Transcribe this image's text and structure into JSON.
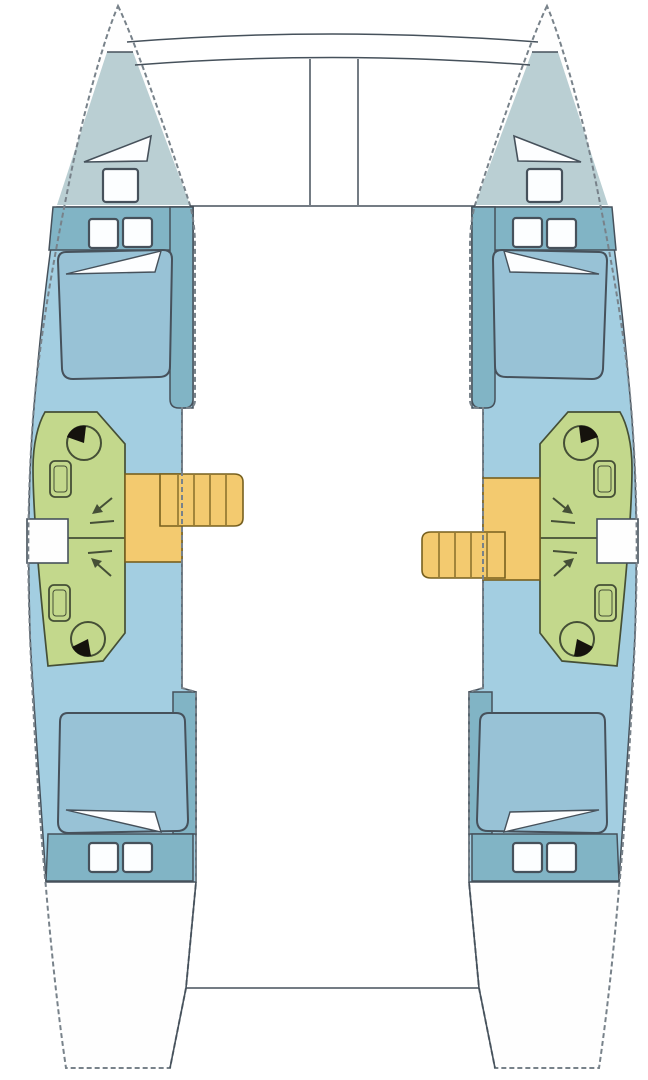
{
  "title": "Catamaran deck and cabin layout floor plan",
  "colors": {
    "background": "#ffffff",
    "hull_fill": "#fefefe",
    "hull_outline_dash": "#78828a",
    "line": "#46515b",
    "forepeak_fill": "#bacfd3",
    "cabin_fill": "#a3cee1",
    "berth_fill": "#98c2d6",
    "coachroof_fill": "#81b4c5",
    "hatch_fill": "#fcfeff",
    "head_fill": "#c3d88c",
    "head_line": "#454f36",
    "stairs_fill": "#f3ca6f",
    "stairs_line": "#77601f",
    "toilet_lid": "#15120d",
    "pillow_fill": "#fdfeff"
  },
  "hulls": [
    {
      "id": "port-hull",
      "mirrored": false,
      "companionway_stairs": "forward",
      "compartments": [
        "forepeak-sail-locker",
        "forward-double-cabin",
        "forward-head-with-shower",
        "companionway",
        "aft-head-with-shower",
        "aft-double-cabin"
      ],
      "fixture_counts": {
        "deck_hatches": 5,
        "double_berths": 2,
        "toilets": 2,
        "sinks": 2,
        "showers": 2,
        "hull_windows": 1
      }
    },
    {
      "id": "starboard-hull",
      "mirrored": true,
      "companionway_stairs": "aft",
      "compartments": [
        "forepeak-sail-locker",
        "forward-double-cabin",
        "forward-head-with-shower",
        "companionway",
        "aft-head-with-shower",
        "aft-double-cabin"
      ],
      "fixture_counts": {
        "deck_hatches": 5,
        "double_berths": 2,
        "toilets": 2,
        "sinks": 2,
        "showers": 2,
        "hull_windows": 1
      }
    }
  ],
  "foredeck": {
    "crossbeams": 2,
    "trampoline_panels": 2,
    "central_walkway": true
  },
  "aft": {
    "cockpit_platform": true
  }
}
